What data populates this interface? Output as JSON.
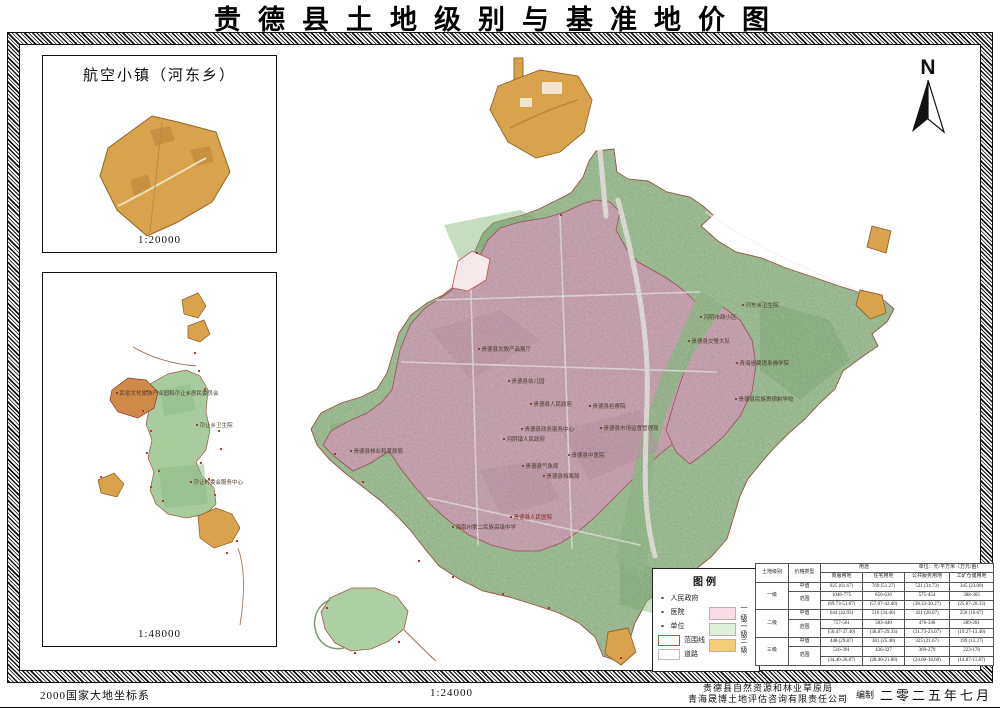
{
  "title": "贵德县土地级别与基准地价图",
  "north": {
    "label": "N"
  },
  "inset_airport": {
    "title": "航空小镇（河东乡）",
    "scale": "1:20000"
  },
  "inset_township": {
    "scale": "1:48000",
    "labels": [
      {
        "text": "民俗文化旅游产业园和尕让乡居民委员会",
        "x": 116,
        "y": 392
      },
      {
        "text": "尕让乡卫生院",
        "x": 196,
        "y": 424
      },
      {
        "text": "尕让村委会服务中心",
        "x": 190,
        "y": 481
      }
    ]
  },
  "main_map": {
    "labels": [
      {
        "text": "贵德县文教产品展厅",
        "x": 478,
        "y": 348
      },
      {
        "text": "贵德县幼儿园",
        "x": 508,
        "y": 380
      },
      {
        "text": "贵德县人民政府",
        "x": 530,
        "y": 403
      },
      {
        "text": "贵德县检察院",
        "x": 589,
        "y": 405
      },
      {
        "text": "贵德县政务服务中心",
        "x": 521,
        "y": 428
      },
      {
        "text": "贵德县市场监督管理局",
        "x": 600,
        "y": 427
      },
      {
        "text": "河阴镇人民政府",
        "x": 503,
        "y": 438
      },
      {
        "text": "贵德县林业和草原局",
        "x": 350,
        "y": 450
      },
      {
        "text": "贵德县中医院",
        "x": 568,
        "y": 454
      },
      {
        "text": "贵德县气象局",
        "x": 522,
        "y": 465
      },
      {
        "text": "贵德县档案局",
        "x": 543,
        "y": 475
      },
      {
        "text": "贵德县人民医院",
        "x": 510,
        "y": 516,
        "color": "#8b1f1f"
      },
      {
        "text": "海南州第二民族高级中学",
        "x": 452,
        "y": 526
      },
      {
        "text": "河东乡卫生院",
        "x": 742,
        "y": 304
      },
      {
        "text": "河阴市政小区",
        "x": 700,
        "y": 316
      },
      {
        "text": "贵德县交警大队",
        "x": 688,
        "y": 340
      },
      {
        "text": "青海省藏语系佛学院",
        "x": 736,
        "y": 362
      },
      {
        "text": "贵德县民族寄宿制学校",
        "x": 735,
        "y": 398
      }
    ]
  },
  "legend": {
    "title": "图例",
    "point_items": [
      {
        "label": "人民政府"
      },
      {
        "label": "医院"
      },
      {
        "label": "单位"
      }
    ],
    "shape_items": [
      {
        "label": "范围线"
      },
      {
        "label": "道路"
      }
    ],
    "grades": [
      {
        "label": "一级",
        "color": "#f7dce5"
      },
      {
        "label": "二级",
        "color": "#def0d9"
      },
      {
        "label": "三级",
        "color": "#f4cd79"
      }
    ]
  },
  "price_table": {
    "col_level": "土地级别",
    "col_price_type": "价格类型",
    "col_use": "用途",
    "unit_note": "单位：元/平方米（万元/亩）",
    "use_cols": [
      "商服用地",
      "住宅用地",
      "公共服务用地",
      "工矿仓储用地"
    ],
    "mid_label": "中值",
    "range_label": "范围",
    "levels": [
      {
        "name": "一级",
        "mid": [
          "925 (61.67)",
          "769 (51.27)",
          "521 (34.73)",
          "345 (23.00)"
        ],
        "range": [
          "1046-775",
          "856-636",
          "575-454",
          "388-305"
        ],
        "range_wan": [
          "(69.73-51.67)",
          "(57.07-42.40)",
          "(38.33-30.27)",
          "(25.87-20.33)"
        ]
      },
      {
        "name": "二级",
        "mid": [
          "644 (42.93)",
          "516 (34.40)",
          "421 (28.07)",
          "250 (16.67)"
        ],
        "range": [
          "757-561",
          "583-440",
          "476-346",
          "289-201"
        ],
        "range_wan": [
          "(50.47-37.40)",
          "(38.87-29.33)",
          "(31.73-23.07)",
          "(19.27-13.40)"
        ]
      },
      {
        "name": "三级",
        "mid": [
          "448 (29.87)",
          "381 (25.40)",
          "325 (21.67)",
          "199 (13.27)"
        ],
        "range": [
          "516-391",
          "426-327",
          "369-279",
          "223-178"
        ],
        "range_wan": [
          "(34.40-26.07)",
          "(28.40-21.80)",
          "(24.60-18.60)",
          "(14.87-11.87)"
        ]
      }
    ]
  },
  "footer": {
    "datum": "2000国家大地坐标系",
    "scale": "1:24000",
    "org1": "贵德县自然资源和林业草原局",
    "org2": "青海晟博土地评估咨询有限责任公司",
    "credit": "编制",
    "date": "二零二五年七月"
  },
  "map_colors": {
    "grade1_pink": "#d9b3c1",
    "grade2_green": "#aecfa4",
    "grade3_orange": "#d9a24c",
    "boundary_red": "#a8443a",
    "road_white": "#f7f4ef"
  }
}
